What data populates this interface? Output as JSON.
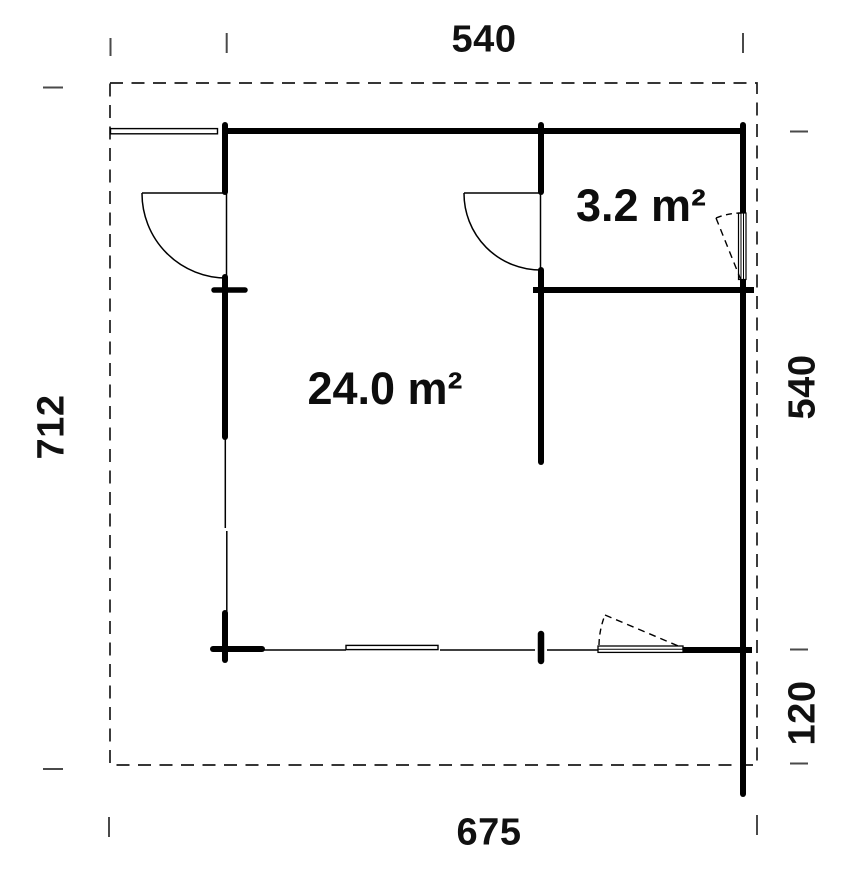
{
  "plan": {
    "rooms": {
      "main": {
        "area_label": "24.0 m²"
      },
      "side": {
        "area_label": "3.2 m²"
      }
    },
    "dimensions": {
      "top_width": "540",
      "left_height": "712",
      "right_height": "540",
      "right_offset": "120",
      "bottom_width": "675"
    },
    "colors": {
      "wall": "#000000",
      "boundary": "#1a1a1a",
      "tick": "#4a4a4a",
      "background": "#ffffff"
    }
  }
}
